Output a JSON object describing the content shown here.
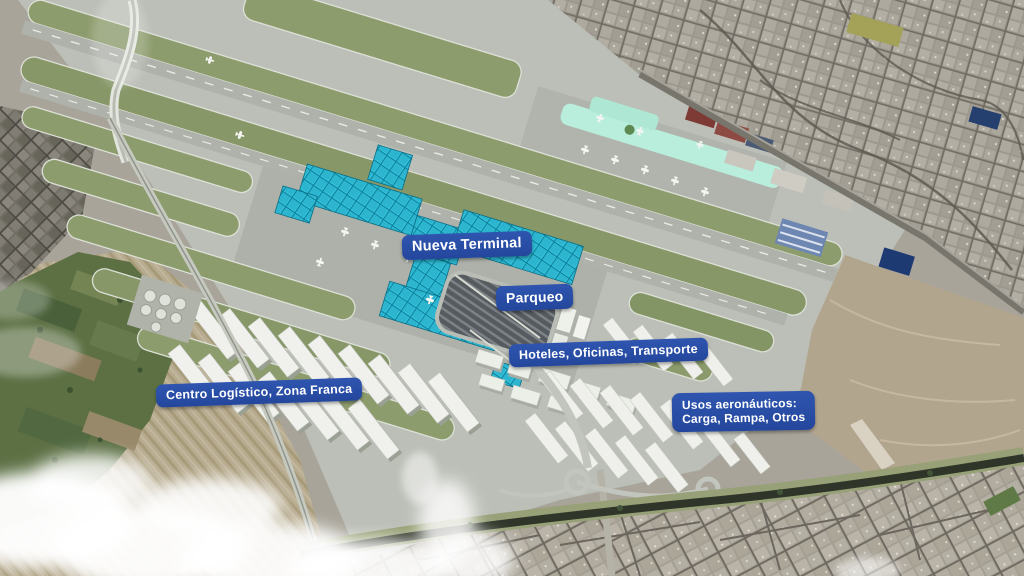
{
  "annotations": {
    "nueva_terminal": "Nueva Terminal",
    "parqueo": "Parqueo",
    "hoteles_oficinas_transporte": "Hoteles, Oficinas, Transporte",
    "centro_logistico_zona_franca": "Centro Logístico, Zona Franca",
    "usos_aeronauticos_line1": "Usos aeronáuticos:",
    "usos_aeronauticos_line2": "Carga, Rampa, Otros"
  },
  "colors": {
    "annotation_background": "#2a4da6",
    "annotation_text": "#ffffff",
    "new_terminal_highlight": "#31c0d9",
    "existing_terminal": "#b9eedd",
    "airfield_grass": "#8d9c6d",
    "tarmac": "#bcbfb7",
    "dirt_area": "#b2a58e",
    "river_water": "#2f3629",
    "clouds": "#ffffff"
  }
}
